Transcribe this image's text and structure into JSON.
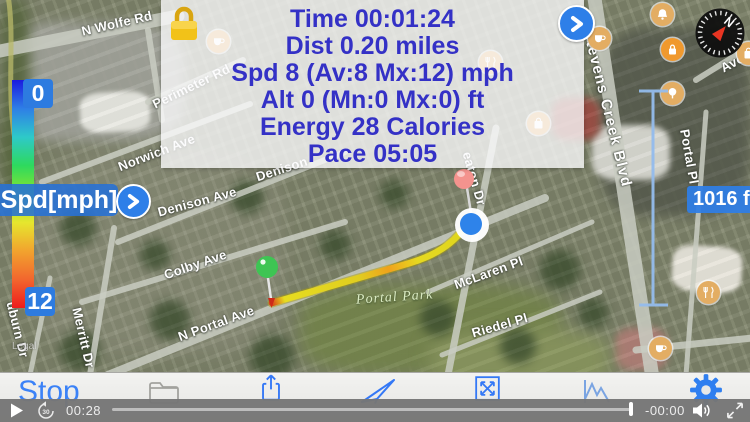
{
  "stats_panel": {
    "lock_icon": "gold-padlock-icon",
    "next_icon": "chevron-right-icon",
    "lines": [
      "Time 00:01:24",
      "Dist 0.20 miles",
      "Spd 8 (Av:8 Mx:12) mph",
      "Alt 0 (Mn:0 Mx:0) ft",
      "Energy 28 Calories",
      "Pace 05:05"
    ]
  },
  "speed_scale": {
    "title": "Spd[mph]",
    "min_label": "0",
    "max_label": "12",
    "expand_icon": "chevron-right-icon",
    "gradient_colors": [
      "#1a1ae0",
      "#2e7fe6",
      "#2ec9c9",
      "#2ed95e",
      "#8ae62e",
      "#e6e62e",
      "#f2a32e",
      "#f2662e",
      "#ee1c1c"
    ]
  },
  "distance_ruler": {
    "label": "1016 ft"
  },
  "compass": {
    "north_label": "N",
    "needle_color": "#e83522"
  },
  "map": {
    "park_label": "Portal Park",
    "legal_label": "Legal",
    "streets": [
      {
        "name": "N Wolfe Rd",
        "x": 80,
        "y": 24,
        "rot": -13
      },
      {
        "name": "Perimeter Rd",
        "x": 150,
        "y": 98,
        "rot": -26
      },
      {
        "name": "Norwich Ave",
        "x": 116,
        "y": 160,
        "rot": -21
      },
      {
        "name": "Denison Ave",
        "x": 156,
        "y": 205,
        "rot": -15
      },
      {
        "name": "Denison",
        "x": 254,
        "y": 170,
        "rot": -18
      },
      {
        "name": "Colby Ave",
        "x": 162,
        "y": 268,
        "rot": -19
      },
      {
        "name": "N Portal Ave",
        "x": 176,
        "y": 330,
        "rot": -20
      },
      {
        "name": "Merritt Dr",
        "x": 84,
        "y": 306,
        "rot": 77
      },
      {
        "name": "uburn Dr",
        "x": 18,
        "y": 300,
        "rot": 76
      },
      {
        "name": "McLaren Pl",
        "x": 452,
        "y": 278,
        "rot": -20
      },
      {
        "name": "Riedel Pl",
        "x": 470,
        "y": 326,
        "rot": -16
      },
      {
        "name": "eaton Dr",
        "x": 474,
        "y": 150,
        "rot": 74
      },
      {
        "name": "Stevens Creek Blvd",
        "x": 596,
        "y": 28,
        "rot": 76,
        "size": 15
      },
      {
        "name": "Portal Pl",
        "x": 692,
        "y": 128,
        "rot": 80
      },
      {
        "name": "Avoc",
        "x": 718,
        "y": 62,
        "rot": -28
      }
    ],
    "pois": [
      {
        "type": "cafe",
        "x": 207,
        "y": 30
      },
      {
        "type": "restaurant",
        "x": 479,
        "y": 51
      },
      {
        "type": "bag",
        "x": 527,
        "y": 112
      },
      {
        "type": "cafe",
        "x": 588,
        "y": 27
      },
      {
        "type": "bell",
        "x": 651,
        "y": 3
      },
      {
        "type": "lock",
        "x": 661,
        "y": 38,
        "variant": "orange"
      },
      {
        "type": "tree",
        "x": 661,
        "y": 82
      },
      {
        "type": "bag",
        "x": 737,
        "y": 42
      },
      {
        "type": "restaurant",
        "x": 697,
        "y": 281
      },
      {
        "type": "cafe",
        "x": 649,
        "y": 337
      }
    ],
    "markers": [
      "route-start-green-pin",
      "dropped-red-pin",
      "current-location-blue-dot"
    ]
  },
  "toolbar": {
    "stop_label": "Stop",
    "icons": [
      "folder-icon",
      "share-icon",
      "send-icon",
      "expand-icon",
      "chart-icon",
      "gear-icon"
    ]
  },
  "video_controls": {
    "elapsed": "00:28",
    "remaining": "-00:00",
    "icons": [
      "play-icon",
      "skip-back-30-icon",
      "volume-icon",
      "fullscreen-icon"
    ]
  },
  "colors": {
    "accent_blue": "#3478f6",
    "panel_text_blue": "#3431c6",
    "badge_blue": "#2d7be0",
    "gold": "#eebc1c",
    "ruler_blue": "#94bced"
  }
}
